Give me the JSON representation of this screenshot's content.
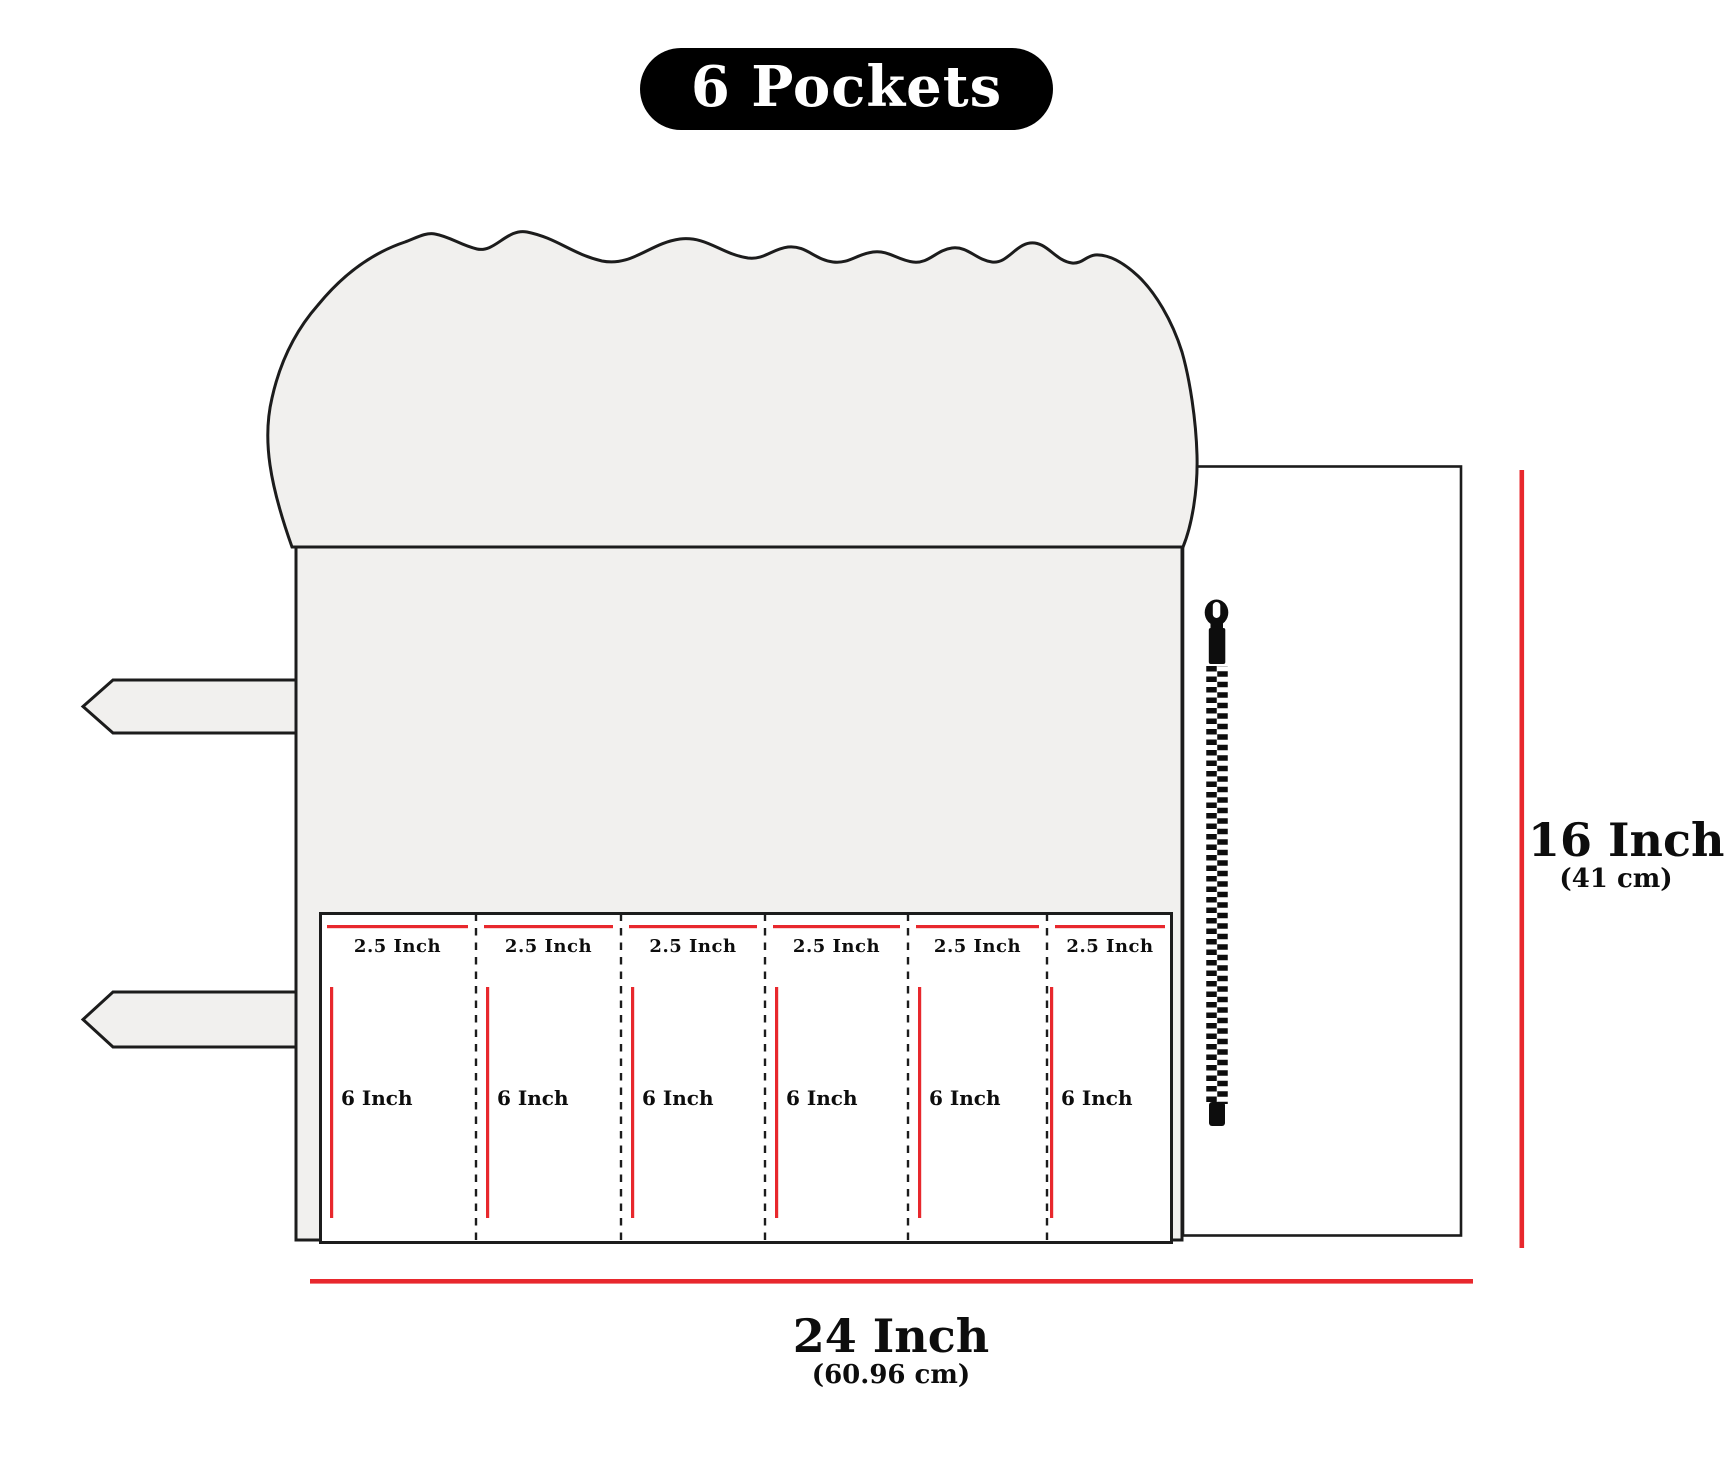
{
  "title": {
    "label": "6 Pockets"
  },
  "pockets": [
    {
      "width_label": "2.5 Inch",
      "depth_label": "6 Inch"
    },
    {
      "width_label": "2.5 Inch",
      "depth_label": "6 Inch"
    },
    {
      "width_label": "2.5 Inch",
      "depth_label": "6 Inch"
    },
    {
      "width_label": "2.5 Inch",
      "depth_label": "6 Inch"
    },
    {
      "width_label": "2.5 Inch",
      "depth_label": "6 Inch"
    },
    {
      "width_label": "2.5 Inch",
      "depth_label": "6 Inch"
    }
  ],
  "dimensions": {
    "width": {
      "label": "24 Inch",
      "metric": "(60.96 cm)"
    },
    "height": {
      "label": "16 Inch",
      "metric": "(41 cm)"
    }
  },
  "colors": {
    "measure_red": "#e8282d",
    "fabric": "#f1f0ee",
    "outline": "#1c1c1c",
    "badge_bg": "#000000",
    "badge_text": "#ffffff"
  }
}
